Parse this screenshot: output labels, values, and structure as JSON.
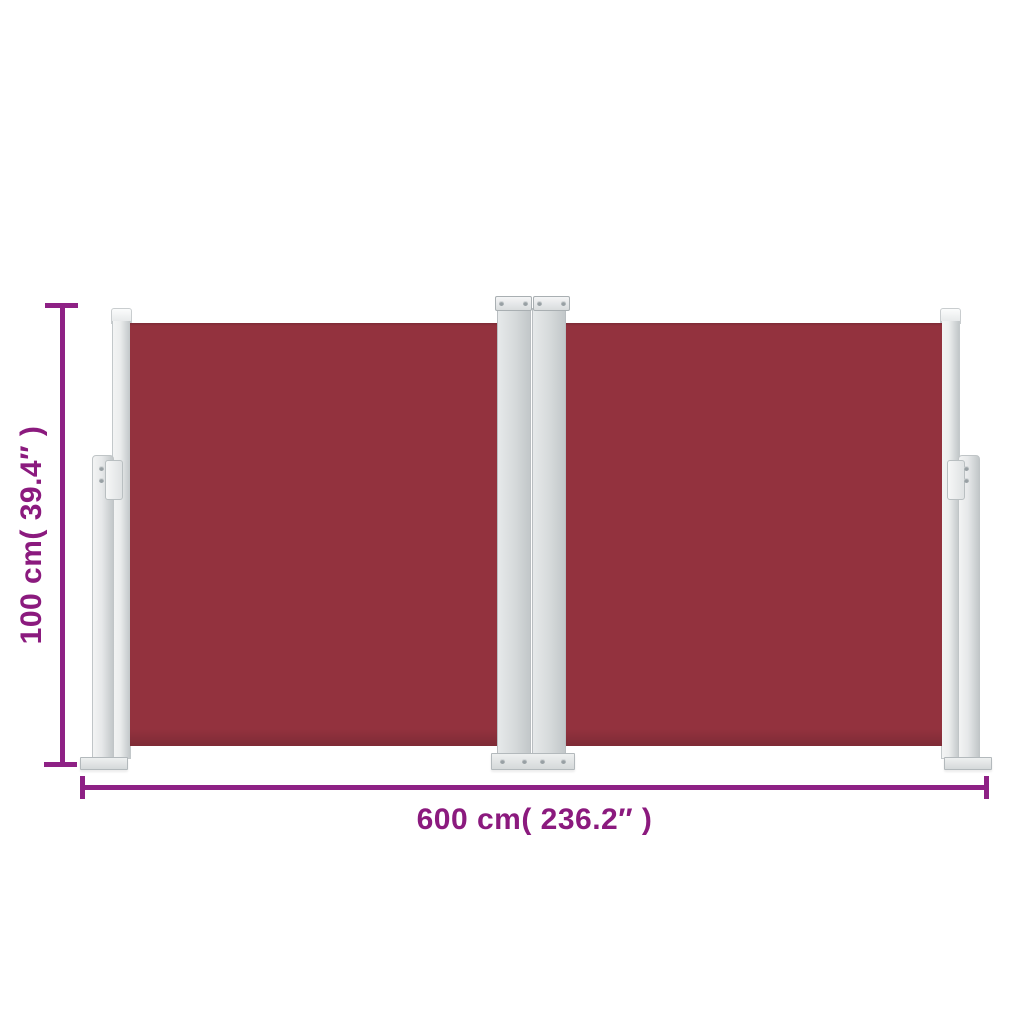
{
  "scene": {
    "type": "product-dimension-diagram",
    "product_name": "retractable double side awning, red",
    "background": "#ffffff"
  },
  "colors": {
    "fabric": "#93323E",
    "fabric_dark": "#7E2B36",
    "frame_light": "#F3F4F4",
    "frame_mid": "#D5D9DA",
    "frame_dark": "#C2C7C9",
    "screw": "#98A0A4",
    "dimension": "#8E2185",
    "label_text": "#8B1A7E"
  },
  "dimensions": {
    "height_label": "100 cm( 39.4″ )",
    "width_label": "600 cm( 236.2″ )"
  }
}
